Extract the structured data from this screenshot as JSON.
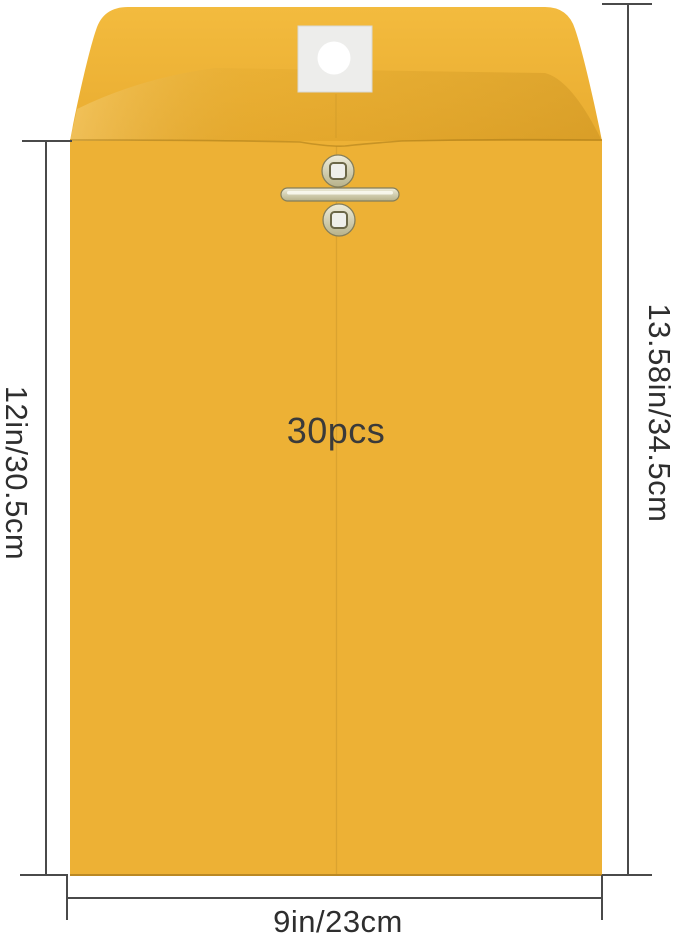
{
  "labels": {
    "quantity": "30pcs",
    "dimension_left": "12in/30.5cm",
    "dimension_right": "13.58in/34.5cm",
    "dimension_bottom": "9in/23cm"
  },
  "colors": {
    "background": "#FFFFFF",
    "envelope_body": "#EDB135",
    "flap_top": "#F3BB3E",
    "flap_bottom": "#E9AC30",
    "fold_line": "#A87A18",
    "seam_line": "#B98A24",
    "bottom_edge": "#8F6616",
    "patch": "#EDEDEB",
    "patch_border": "#D9D9D5",
    "hole": "#FFFFFF",
    "clasp_metal_light": "#EFEDDB",
    "clasp_metal_dark": "#B7B28A",
    "clasp_outline": "#847E5B",
    "clasp_hole": "#EFEFEA",
    "dimension_line": "#4A4A4A",
    "dimension_text": "#2E2E2E",
    "quantity_text": "#3A3A3A"
  }
}
